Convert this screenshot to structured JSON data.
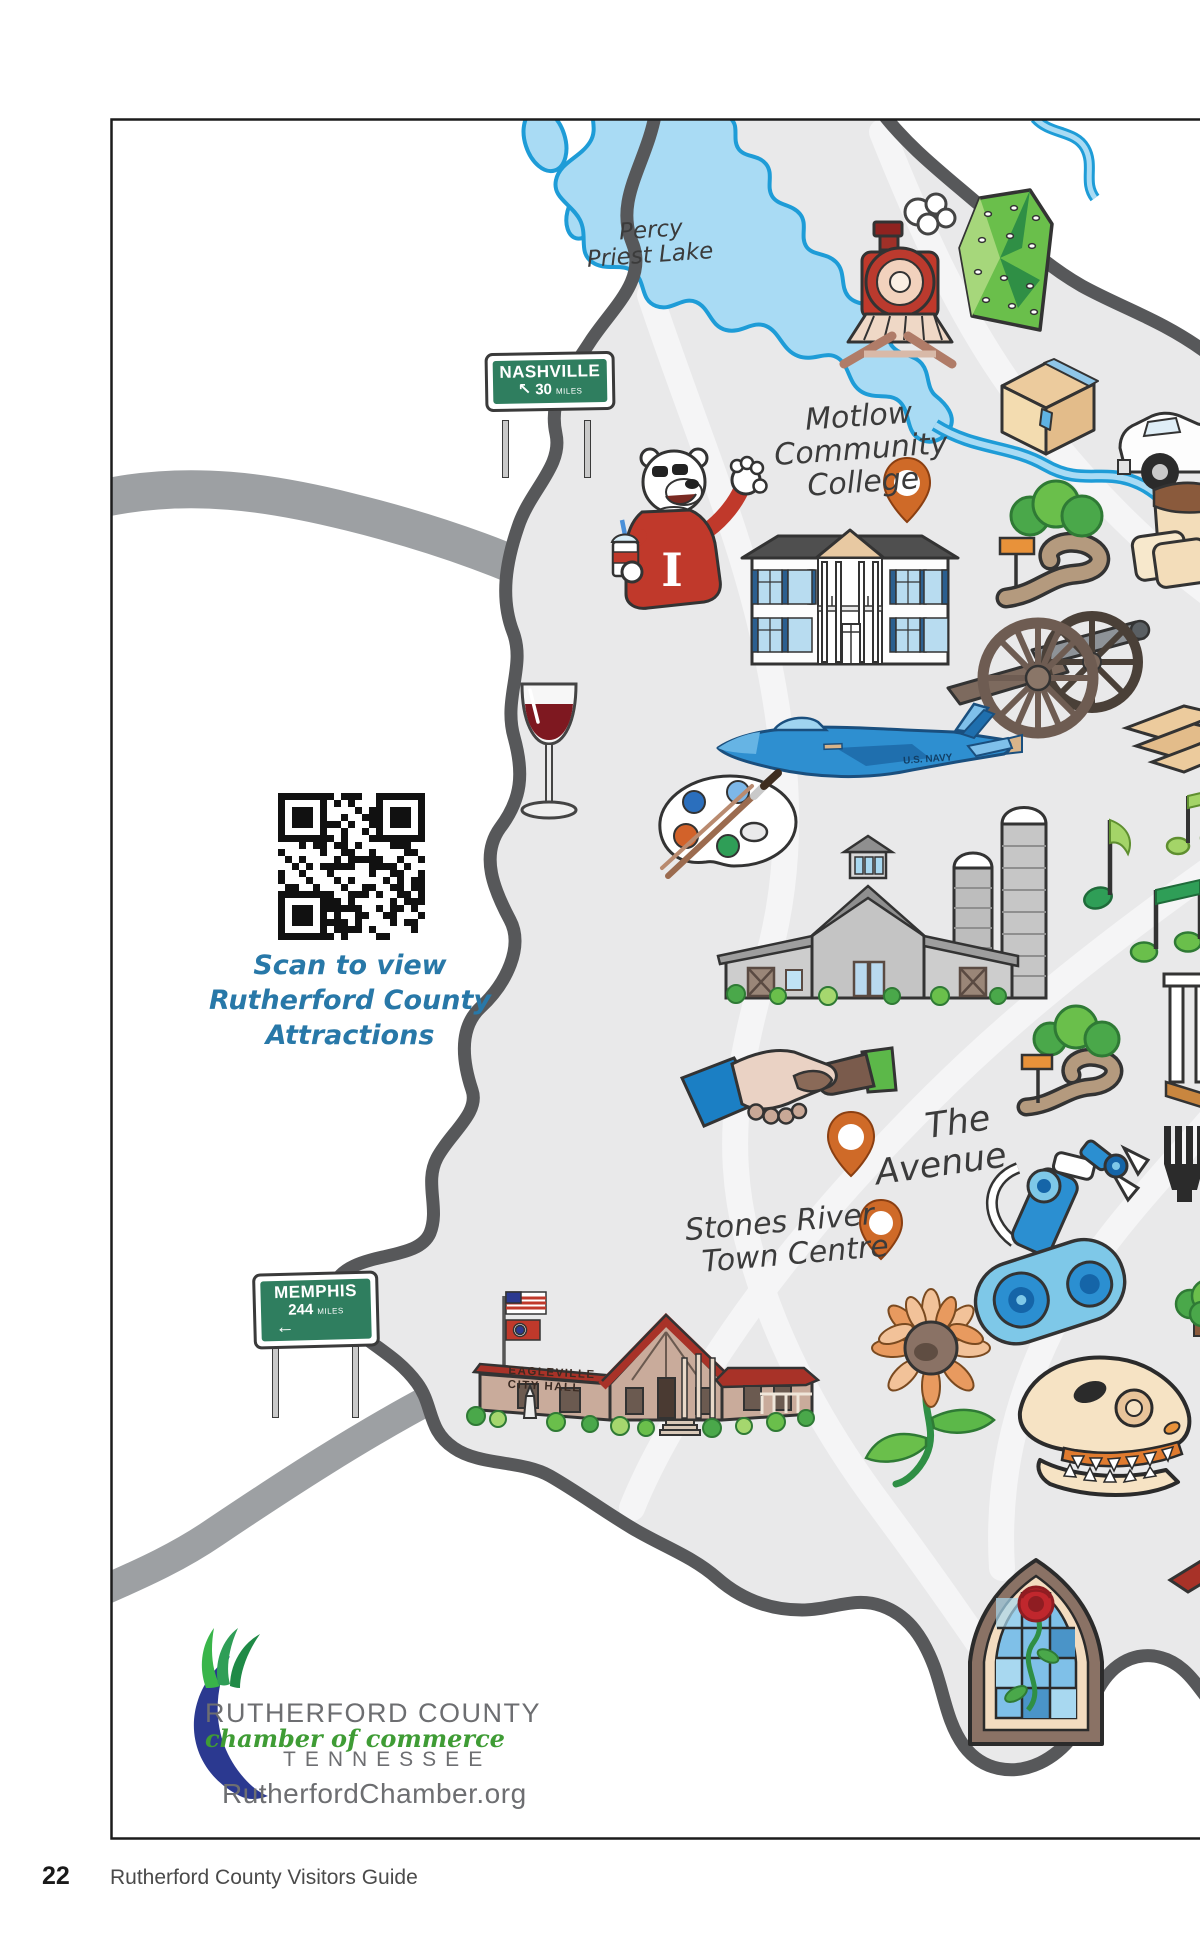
{
  "illustrations": [
    "percy-priest-lake",
    "steam-train",
    "climbing-wall",
    "shipping-box",
    "pickup-truck",
    "nashville-sign",
    "icee-bear-mascot",
    "oaklands-mansion",
    "greenway-trail",
    "bread-loaf",
    "civil-war-cannon",
    "lumber-planks",
    "navy-jet",
    "wine-glass",
    "paint-palette",
    "music-notes",
    "barn-with-silos",
    "qr-code",
    "handshake",
    "location-pin",
    "robot-arm",
    "fork",
    "memphis-sign",
    "eagleville-city-hall",
    "sunflower",
    "trex-skull",
    "tree",
    "stained-glass-window",
    "chamber-logo"
  ],
  "labels": {
    "percy_priest": {
      "line1": "Percy",
      "line2": "Priest Lake"
    },
    "motlow": {
      "line1": "Motlow",
      "line2": "Community",
      "line3": "College"
    },
    "avenue": {
      "line1": "The",
      "line2": "Avenue"
    },
    "stones_river": {
      "line1": "Stones River",
      "line2": "Town Centre"
    },
    "eagleville": {
      "line1": "EAGLEVILLE",
      "line2": "CITY HALL"
    },
    "jet_text": "U.S. NAVY",
    "mascot_letter": "I"
  },
  "signs": {
    "nashville": {
      "city": "NASHVILLE",
      "distance": "30",
      "unit": "MILES",
      "arrow": "↖"
    },
    "memphis": {
      "city": "MEMPHIS",
      "distance": "244",
      "unit": "MILES",
      "arrow": "←"
    }
  },
  "qr_caption": {
    "line1": "Scan to view",
    "line2": "Rutherford County",
    "line3": "Attractions"
  },
  "logo": {
    "org": "RUTHERFORD COUNTY",
    "division": "chamber of commerce",
    "state": "TENNESSEE",
    "website": "RutherfordChamber.org"
  },
  "footer": {
    "page_number": "22",
    "guide_title": "Rutherford County Visitors Guide"
  },
  "colors": {
    "county_fill": "#e9e9ea",
    "county_border": "#57585a",
    "road_gray": "#9da0a3",
    "lake_blue": "#a9dbf4",
    "lake_outline": "#1e9cd7",
    "pin_orange": "#cf6a28",
    "sign_green": "#2f7e5f",
    "label_ink": "#3b3b3b",
    "caption_blue": "#2878a8",
    "logo_gray": "#6d6e71",
    "logo_green": "#3f9c35",
    "logo_blue": "#2b3990"
  }
}
